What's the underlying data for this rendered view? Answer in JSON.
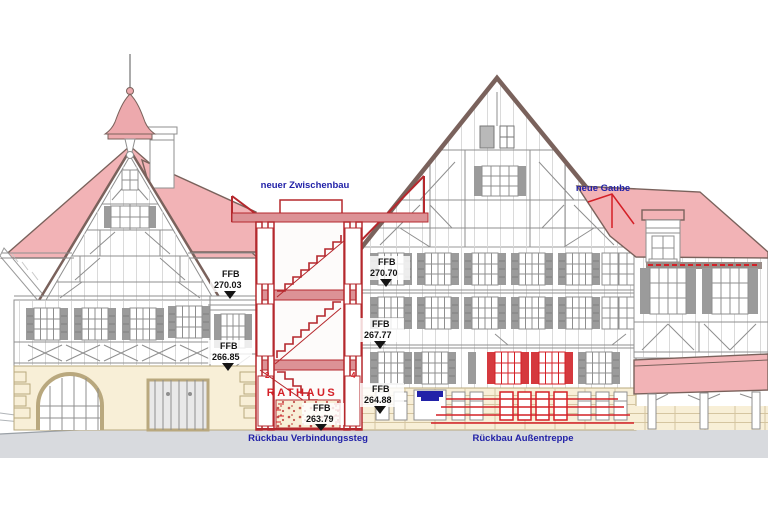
{
  "drawing": {
    "type": "architectural-elevation",
    "annotations": {
      "neuer_zwischenbau": "neuer Zwischenbau",
      "neue_gaube": "neue Gaube",
      "rueckbau_verbindungssteg": "Rückbau Verbindungssteg",
      "rueckbau_aussentreppe": "Rückbau Außentreppe"
    },
    "sign": "RATHAUS",
    "axis_numbers": {
      "left": "2",
      "right": "4"
    },
    "levels": [
      {
        "name": "FFB",
        "value": "270.03"
      },
      {
        "name": "FFB",
        "value": "266.85"
      },
      {
        "name": "FFB",
        "value": "270.70"
      },
      {
        "name": "FFB",
        "value": "267.77"
      },
      {
        "name": "FFB",
        "value": "264.88"
      },
      {
        "name": "FFB",
        "value": "263.79"
      }
    ],
    "colors": {
      "roof-pink": "#f2b3b6",
      "roof-pink-dark": "#eda9ad",
      "construction-red": "#b5282d",
      "bright-red": "#d42027",
      "label-blue": "#2222a8",
      "stone-cream": "#f8efd7",
      "stone-joint": "#d5c5a0",
      "ground-gray": "#d8dade",
      "timber-gray": "#8f8f8f",
      "shutter-gray": "#9b9b9b",
      "roof-edge": "#7a625c"
    }
  }
}
